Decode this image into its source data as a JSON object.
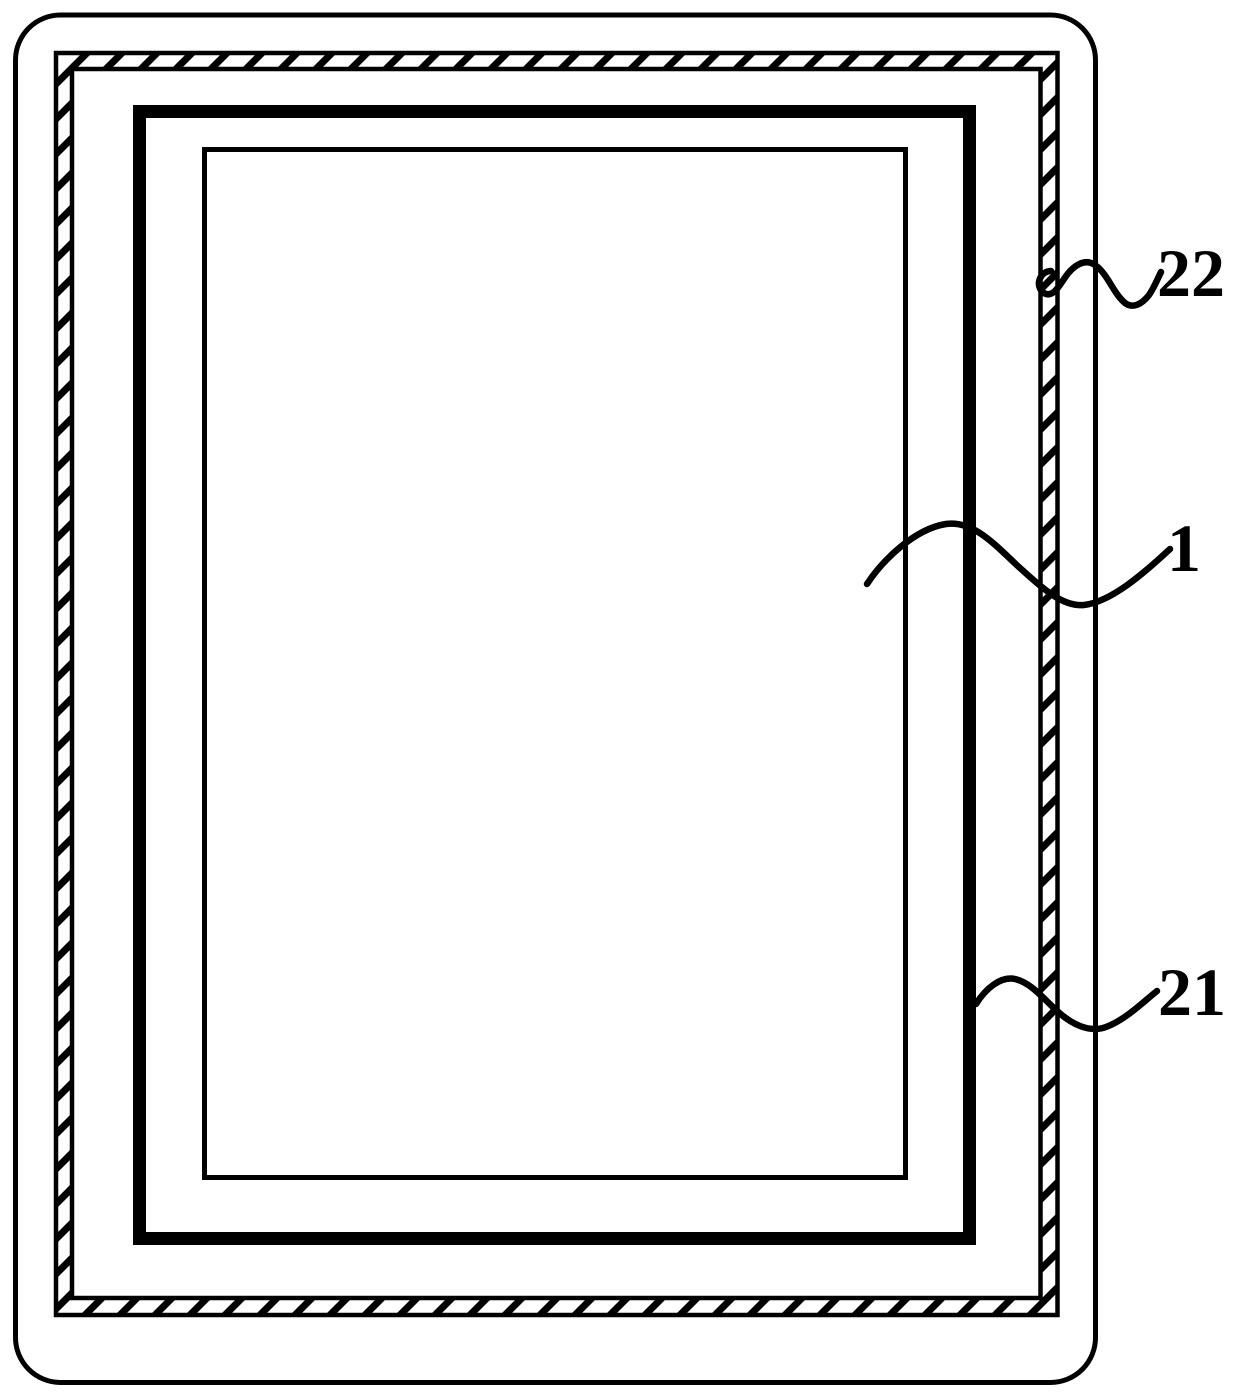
{
  "figure": {
    "colors": {
      "line": "#000000",
      "background": "#ffffff"
    },
    "reference_labels": {
      "ref_22": "22",
      "ref_1": "1",
      "ref_21": "21"
    }
  }
}
